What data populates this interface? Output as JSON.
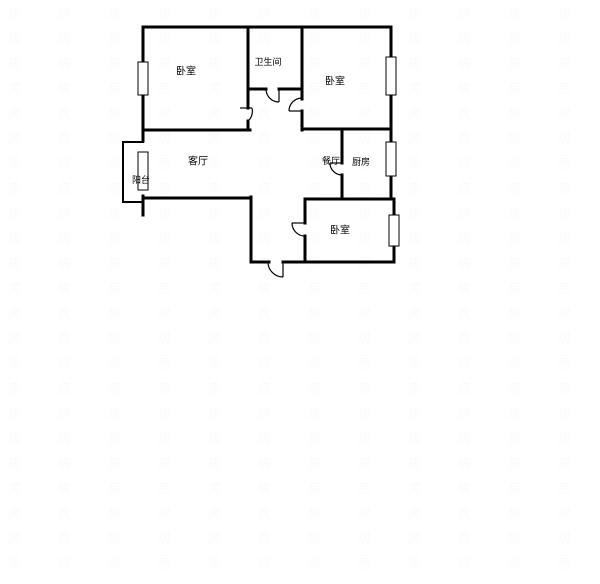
{
  "page": {
    "background": "#ffffff",
    "width": 600,
    "height": 584
  },
  "floorplan": {
    "line_color": "#000000",
    "wall_fill": "#ffffff",
    "rooms": [
      {
        "id": "bedroom-top-left",
        "label": "卧室",
        "x": 186,
        "y": 72,
        "size": 10
      },
      {
        "id": "bathroom",
        "label": "卫生间",
        "x": 268,
        "y": 63,
        "size": 9
      },
      {
        "id": "bedroom-top-right",
        "label": "卧室",
        "x": 335,
        "y": 82,
        "size": 10
      },
      {
        "id": "living-room",
        "label": "客厅",
        "x": 198,
        "y": 162,
        "size": 10
      },
      {
        "id": "dining-room",
        "label": "餐厅",
        "x": 331,
        "y": 162,
        "size": 9
      },
      {
        "id": "kitchen",
        "label": "厨房",
        "x": 361,
        "y": 163,
        "size": 9
      },
      {
        "id": "balcony",
        "label": "阳台",
        "x": 141,
        "y": 181,
        "size": 9
      },
      {
        "id": "bedroom-bottom",
        "label": "卧室",
        "x": 340,
        "y": 231,
        "size": 10
      }
    ],
    "walls": [
      {
        "x1": 143,
        "y1": 27,
        "x2": 391,
        "y2": 27,
        "t": 3
      },
      {
        "x1": 143,
        "y1": 27,
        "x2": 143,
        "y2": 141,
        "t": 3
      },
      {
        "x1": 391,
        "y1": 27,
        "x2": 391,
        "y2": 199,
        "t": 3
      },
      {
        "x1": 248,
        "y1": 28,
        "x2": 248,
        "y2": 108,
        "t": 3
      },
      {
        "x1": 248,
        "y1": 121,
        "x2": 248,
        "y2": 130,
        "t": 3
      },
      {
        "x1": 248,
        "y1": 89,
        "x2": 266,
        "y2": 89,
        "t": 3
      },
      {
        "x1": 279,
        "y1": 89,
        "x2": 302,
        "y2": 89,
        "t": 3
      },
      {
        "x1": 302,
        "y1": 28,
        "x2": 302,
        "y2": 99,
        "t": 3
      },
      {
        "x1": 302,
        "y1": 111,
        "x2": 302,
        "y2": 130,
        "t": 3
      },
      {
        "x1": 143,
        "y1": 130,
        "x2": 250,
        "y2": 130,
        "t": 3
      },
      {
        "x1": 302,
        "y1": 129,
        "x2": 391,
        "y2": 129,
        "t": 3
      },
      {
        "x1": 342,
        "y1": 129,
        "x2": 342,
        "y2": 163,
        "t": 3
      },
      {
        "x1": 342,
        "y1": 175,
        "x2": 342,
        "y2": 199,
        "t": 3
      },
      {
        "x1": 143,
        "y1": 198,
        "x2": 251,
        "y2": 198,
        "t": 3
      },
      {
        "x1": 143,
        "y1": 196,
        "x2": 143,
        "y2": 215,
        "t": 3
      },
      {
        "x1": 251,
        "y1": 197,
        "x2": 251,
        "y2": 262,
        "t": 3
      },
      {
        "x1": 251,
        "y1": 262,
        "x2": 269,
        "y2": 262,
        "t": 3
      },
      {
        "x1": 283,
        "y1": 262,
        "x2": 305,
        "y2": 262,
        "t": 3
      },
      {
        "x1": 305,
        "y1": 199,
        "x2": 305,
        "y2": 223,
        "t": 3
      },
      {
        "x1": 305,
        "y1": 236,
        "x2": 305,
        "y2": 262,
        "t": 3
      },
      {
        "x1": 305,
        "y1": 199,
        "x2": 394,
        "y2": 199,
        "t": 3
      },
      {
        "x1": 394,
        "y1": 199,
        "x2": 394,
        "y2": 262,
        "t": 3
      },
      {
        "x1": 305,
        "y1": 262,
        "x2": 394,
        "y2": 262,
        "t": 3
      },
      {
        "x1": 123,
        "y1": 142,
        "x2": 143,
        "y2": 142,
        "t": 2
      },
      {
        "x1": 123,
        "y1": 142,
        "x2": 123,
        "y2": 202,
        "t": 2
      },
      {
        "x1": 123,
        "y1": 202,
        "x2": 143,
        "y2": 202,
        "t": 2
      }
    ],
    "windows": [
      {
        "x": 138,
        "y": 62,
        "w": 10,
        "h": 33
      },
      {
        "x": 138,
        "y": 152,
        "w": 10,
        "h": 38
      },
      {
        "x": 386,
        "y": 57,
        "w": 10,
        "h": 38
      },
      {
        "x": 386,
        "y": 142,
        "w": 10,
        "h": 34
      },
      {
        "x": 389,
        "y": 215,
        "w": 10,
        "h": 31
      }
    ],
    "doors": [
      {
        "name": "bathroom-door",
        "leaf": [
          279,
          89,
          279,
          102
        ],
        "arc": "M 266 89 A 13 13 0 0 0 279 102"
      },
      {
        "name": "bedroom-top-left-door",
        "leaf": [
          240,
          108,
          252,
          108
        ],
        "arc": "M 252 108 A 13 13 0 0 1 248 121"
      },
      {
        "name": "bedroom-top-right-door",
        "leaf": [
          289,
          111,
          302,
          111
        ],
        "arc": "M 289 111 A 13 13 0 0 1 302 98"
      },
      {
        "name": "kitchen-door",
        "leaf": [
          330,
          163,
          342,
          163
        ],
        "arc": "M 330 163 A 12 12 0 0 0 342 175"
      },
      {
        "name": "bedroom-bottom-door",
        "leaf": [
          292,
          223,
          304,
          223
        ],
        "arc": "M 292 223 A 13 13 0 0 0 304 236"
      },
      {
        "name": "entry-door",
        "leaf": [
          283,
          262,
          283,
          277
        ],
        "arc": "M 268 262 A 15 15 0 0 0 283 277"
      }
    ],
    "watermark": {
      "text": "房",
      "x0": 8,
      "y0": 18,
      "dx": 50,
      "dy": 25,
      "cols": 12,
      "rows": 23,
      "font_size": 13,
      "opacity": 0.022
    }
  }
}
